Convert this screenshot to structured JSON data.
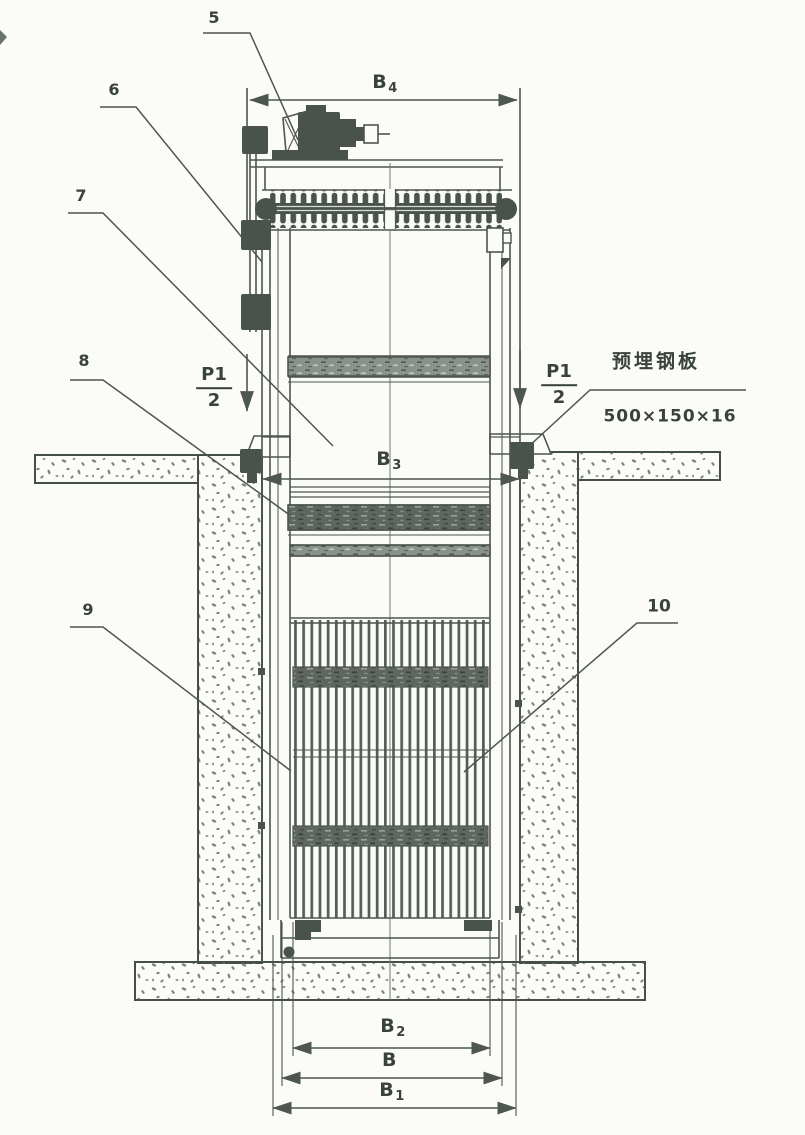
{
  "drawing_type": "mechanical-bar-screen-installation-front-view",
  "callouts": {
    "c5": "5",
    "c6": "6",
    "c7": "7",
    "c8": "8",
    "c9": "9",
    "c10": "10"
  },
  "dimensions": {
    "b4": {
      "main": "B",
      "sub": "4"
    },
    "b3": {
      "main": "B",
      "sub": "3"
    },
    "b2": {
      "main": "B",
      "sub": "2"
    },
    "b": {
      "main": "B",
      "sub": ""
    },
    "b1": {
      "main": "B",
      "sub": "1"
    }
  },
  "loads": {
    "left": {
      "numerator": "P1",
      "denominator": "2"
    },
    "right": {
      "numerator": "P1",
      "denominator": "2"
    }
  },
  "embedded_plate": {
    "label": "预埋钢板",
    "size": "500×150×16"
  },
  "colors": {
    "ink": "#4d564f",
    "dark_fill": "#49534c",
    "paper": "#fbfbf8",
    "concrete_speckle": "#79827b",
    "band_dark": "#5e665f",
    "band_light": "#8b928b"
  }
}
